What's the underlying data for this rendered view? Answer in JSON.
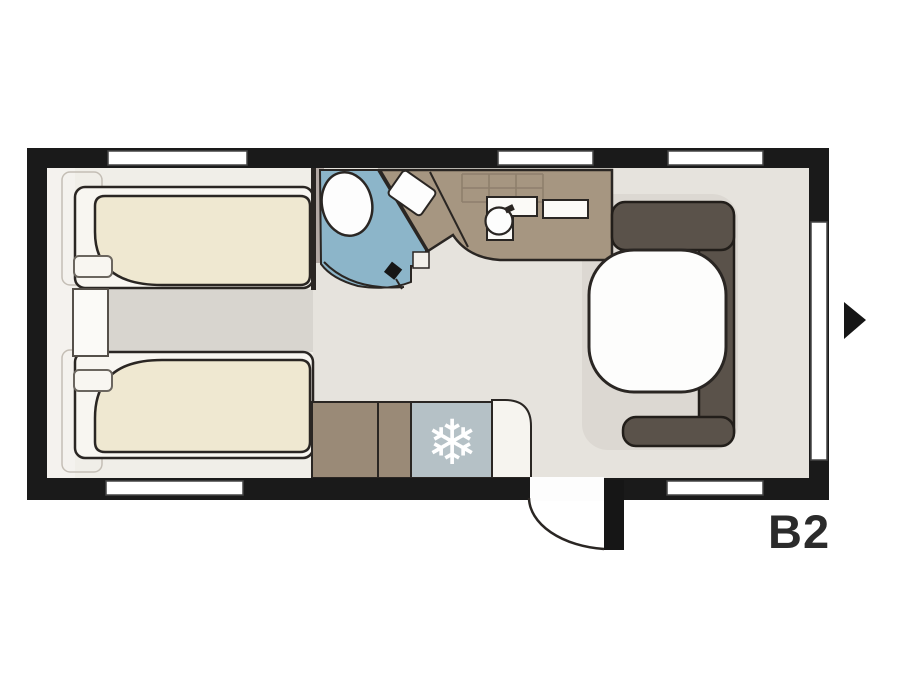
{
  "plan": {
    "model_label": "B2",
    "icons": {
      "snowflake": "❄",
      "direction_arrow": "right-pointing-triangle"
    },
    "colors": {
      "wall": "#1a1a1a",
      "outline": "#2a2623",
      "floor": "#e6e3dd",
      "bedroom_floor": "#f0eee8",
      "aisle_floor": "#d8d5cf",
      "dinette_floor": "#dcd8d2",
      "mattress": "#efe8d1",
      "bed_base": "#f8f6f1",
      "kitchen_counter": "#a69681",
      "lower_cabinet": "#9a8a77",
      "dinette_bench": "#5a524a",
      "washroom_floor": "#8cb5c9",
      "refrigerator": "#b5c1c6",
      "table": "#fdfdfc",
      "label": "#2b2b2b"
    },
    "features": {
      "beds": [
        "single bed front",
        "single bed rear"
      ],
      "washroom": [
        "toilet",
        "corner basin",
        "swing door"
      ],
      "kitchen": [
        "hob",
        "round sink",
        "worktop"
      ],
      "appliances": [
        "refrigerator"
      ],
      "dinette": [
        "U-shaped bench",
        "rounded table"
      ],
      "entrance": [
        "entry door with swing arc"
      ],
      "window_count": 6
    }
  }
}
